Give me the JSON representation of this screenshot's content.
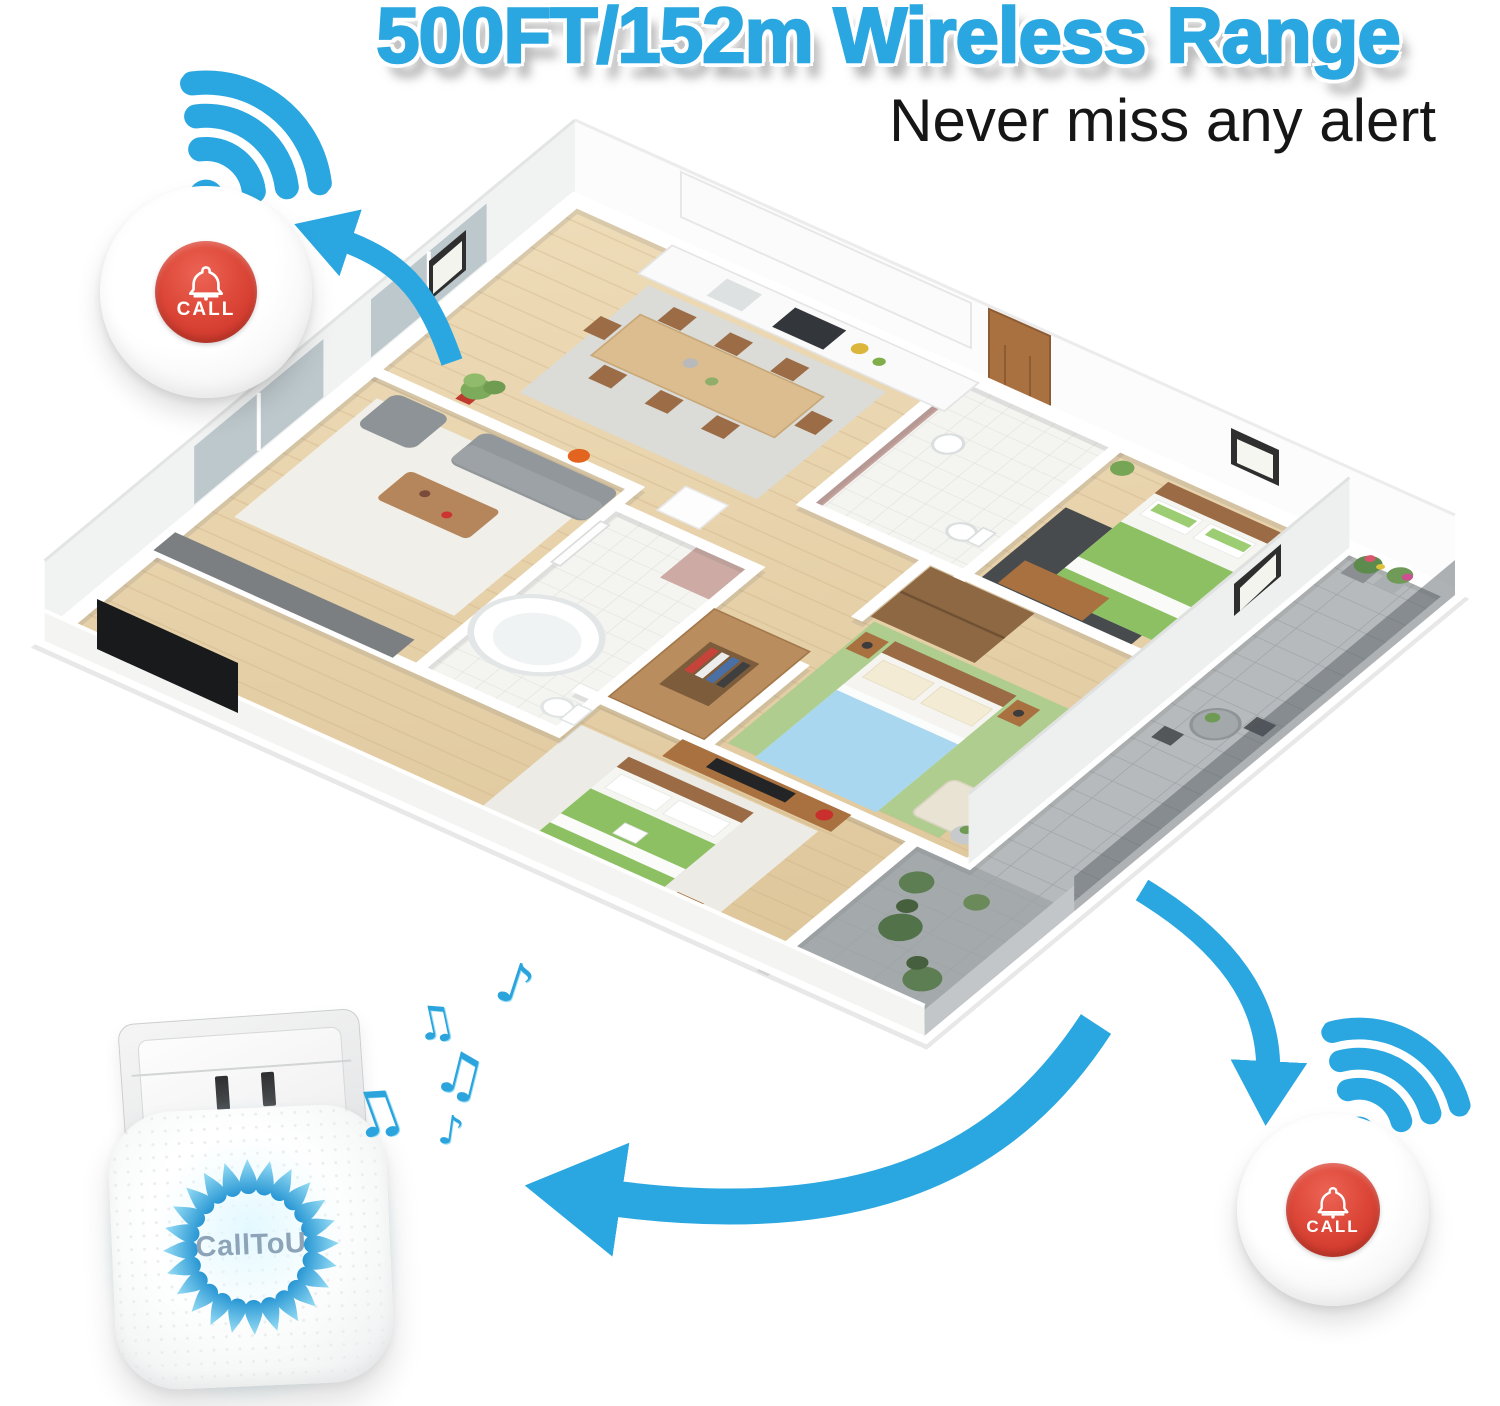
{
  "header": {
    "title": "500FT/152m Wireless Range",
    "subtitle": "Never miss any alert"
  },
  "devices": {
    "call_button_top": {
      "label": "CALL"
    },
    "call_button_bottom": {
      "label": "CALL"
    },
    "receiver": {
      "brand": "CallToU"
    }
  },
  "icons": {
    "wifi_top_left": "wifi-signal",
    "wifi_bottom_right": "wifi-signal",
    "bell": "bell",
    "arrows": [
      "to-top-left-button",
      "to-receiver",
      "to-bottom-right-button"
    ]
  },
  "music_notes": {
    "glyphs": [
      "♪",
      "♫",
      "♫",
      "♫",
      "♪"
    ]
  },
  "colors": {
    "accent_blue": "#2aa7e0",
    "button_red": "#d53b2d",
    "wood_floor": "#e7d4ae",
    "wall_white": "#fcfcfc",
    "rug_green": "#aecd8e",
    "bed_green": "#8cc063",
    "bed_blue": "#a8d7ef"
  },
  "scene": {
    "type": "isometric-apartment-floor-plan"
  }
}
